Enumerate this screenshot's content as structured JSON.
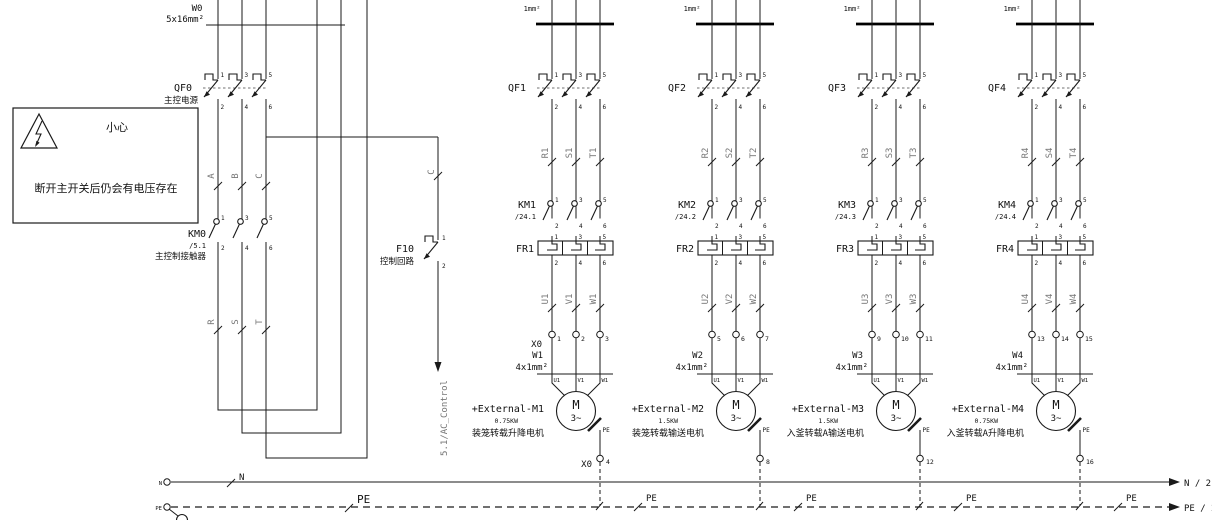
{
  "incomer": {
    "cable": "W0",
    "spec": "5x16mm²",
    "qf": "QF0",
    "qf_desc": "主控电源",
    "km": "KM0",
    "km_ref": "/5.1",
    "km_desc": "主控制接触器",
    "phases": [
      "A",
      "B",
      "C"
    ],
    "out": [
      "R",
      "S",
      "T"
    ]
  },
  "warning": {
    "title": "小心",
    "text": "断开主开关后仍会有电压存在"
  },
  "control": {
    "wire": "C",
    "name": "F10",
    "desc": "控制回路",
    "pin_top": "1",
    "pin_bot": "2",
    "dest": "5.1/AC_Control"
  },
  "pins": {
    "t": [
      "1",
      "3",
      "5"
    ],
    "b": [
      "2",
      "4",
      "6"
    ]
  },
  "branches": [
    {
      "cable_top": "1mm²",
      "qf": "QF1",
      "wires": [
        "R1",
        "S1",
        "T1"
      ],
      "km": "KM1",
      "km_ref": "/24.1",
      "fr": "FR1",
      "motor_wires": [
        "U1",
        "V1",
        "W1"
      ],
      "block": "X0",
      "terminals": [
        "1",
        "2",
        "3"
      ],
      "cable": "W1",
      "spec": "4x1mm²",
      "mterms": [
        "U1",
        "V1",
        "W1"
      ],
      "m": "M",
      "msub": "3~",
      "tag": "+External-M1",
      "power": "0.75KW",
      "desc": "装笼转载升降电机",
      "pe": "PE",
      "pe_term": "4",
      "pe_block": "X0",
      "pe_bus": "PE"
    },
    {
      "cable_top": "1mm²",
      "qf": "QF2",
      "wires": [
        "R2",
        "S2",
        "T2"
      ],
      "km": "KM2",
      "km_ref": "/24.2",
      "fr": "FR2",
      "motor_wires": [
        "U2",
        "V2",
        "W2"
      ],
      "block": "",
      "terminals": [
        "5",
        "6",
        "7"
      ],
      "cable": "W2",
      "spec": "4x1mm²",
      "mterms": [
        "U1",
        "V1",
        "W1"
      ],
      "m": "M",
      "msub": "3~",
      "tag": "+External-M2",
      "power": "1.5KW",
      "desc": "装笼转载输送电机",
      "pe": "PE",
      "pe_term": "8",
      "pe_block": "",
      "pe_bus": "PE"
    },
    {
      "cable_top": "1mm²",
      "qf": "QF3",
      "wires": [
        "R3",
        "S3",
        "T3"
      ],
      "km": "KM3",
      "km_ref": "/24.3",
      "fr": "FR3",
      "motor_wires": [
        "U3",
        "V3",
        "W3"
      ],
      "block": "",
      "terminals": [
        "9",
        "10",
        "11"
      ],
      "cable": "W3",
      "spec": "4x1mm²",
      "mterms": [
        "U1",
        "V1",
        "W1"
      ],
      "m": "M",
      "msub": "3~",
      "tag": "+External-M3",
      "power": "1.5KW",
      "desc": "入釜转载A输送电机",
      "pe": "PE",
      "pe_term": "12",
      "pe_block": "",
      "pe_bus": "PE"
    },
    {
      "cable_top": "1mm²",
      "qf": "QF4",
      "wires": [
        "R4",
        "S4",
        "T4"
      ],
      "km": "KM4",
      "km_ref": "/24.4",
      "fr": "FR4",
      "motor_wires": [
        "U4",
        "V4",
        "W4"
      ],
      "block": "",
      "terminals": [
        "13",
        "14",
        "15"
      ],
      "cable": "W4",
      "spec": "4x1mm²",
      "mterms": [
        "U1",
        "V1",
        "W1"
      ],
      "m": "M",
      "msub": "3~",
      "tag": "+External-M4",
      "power": "0.75KW",
      "desc": "入釜转载A升降电机",
      "pe": "PE",
      "pe_term": "16",
      "pe_block": "",
      "pe_bus": "PE"
    }
  ],
  "buses": {
    "n": {
      "term": "N",
      "label": "N",
      "dest": "N / 2.1"
    },
    "pe": {
      "term": "PE",
      "label": "PE",
      "dest": "PE / 2.1"
    }
  }
}
